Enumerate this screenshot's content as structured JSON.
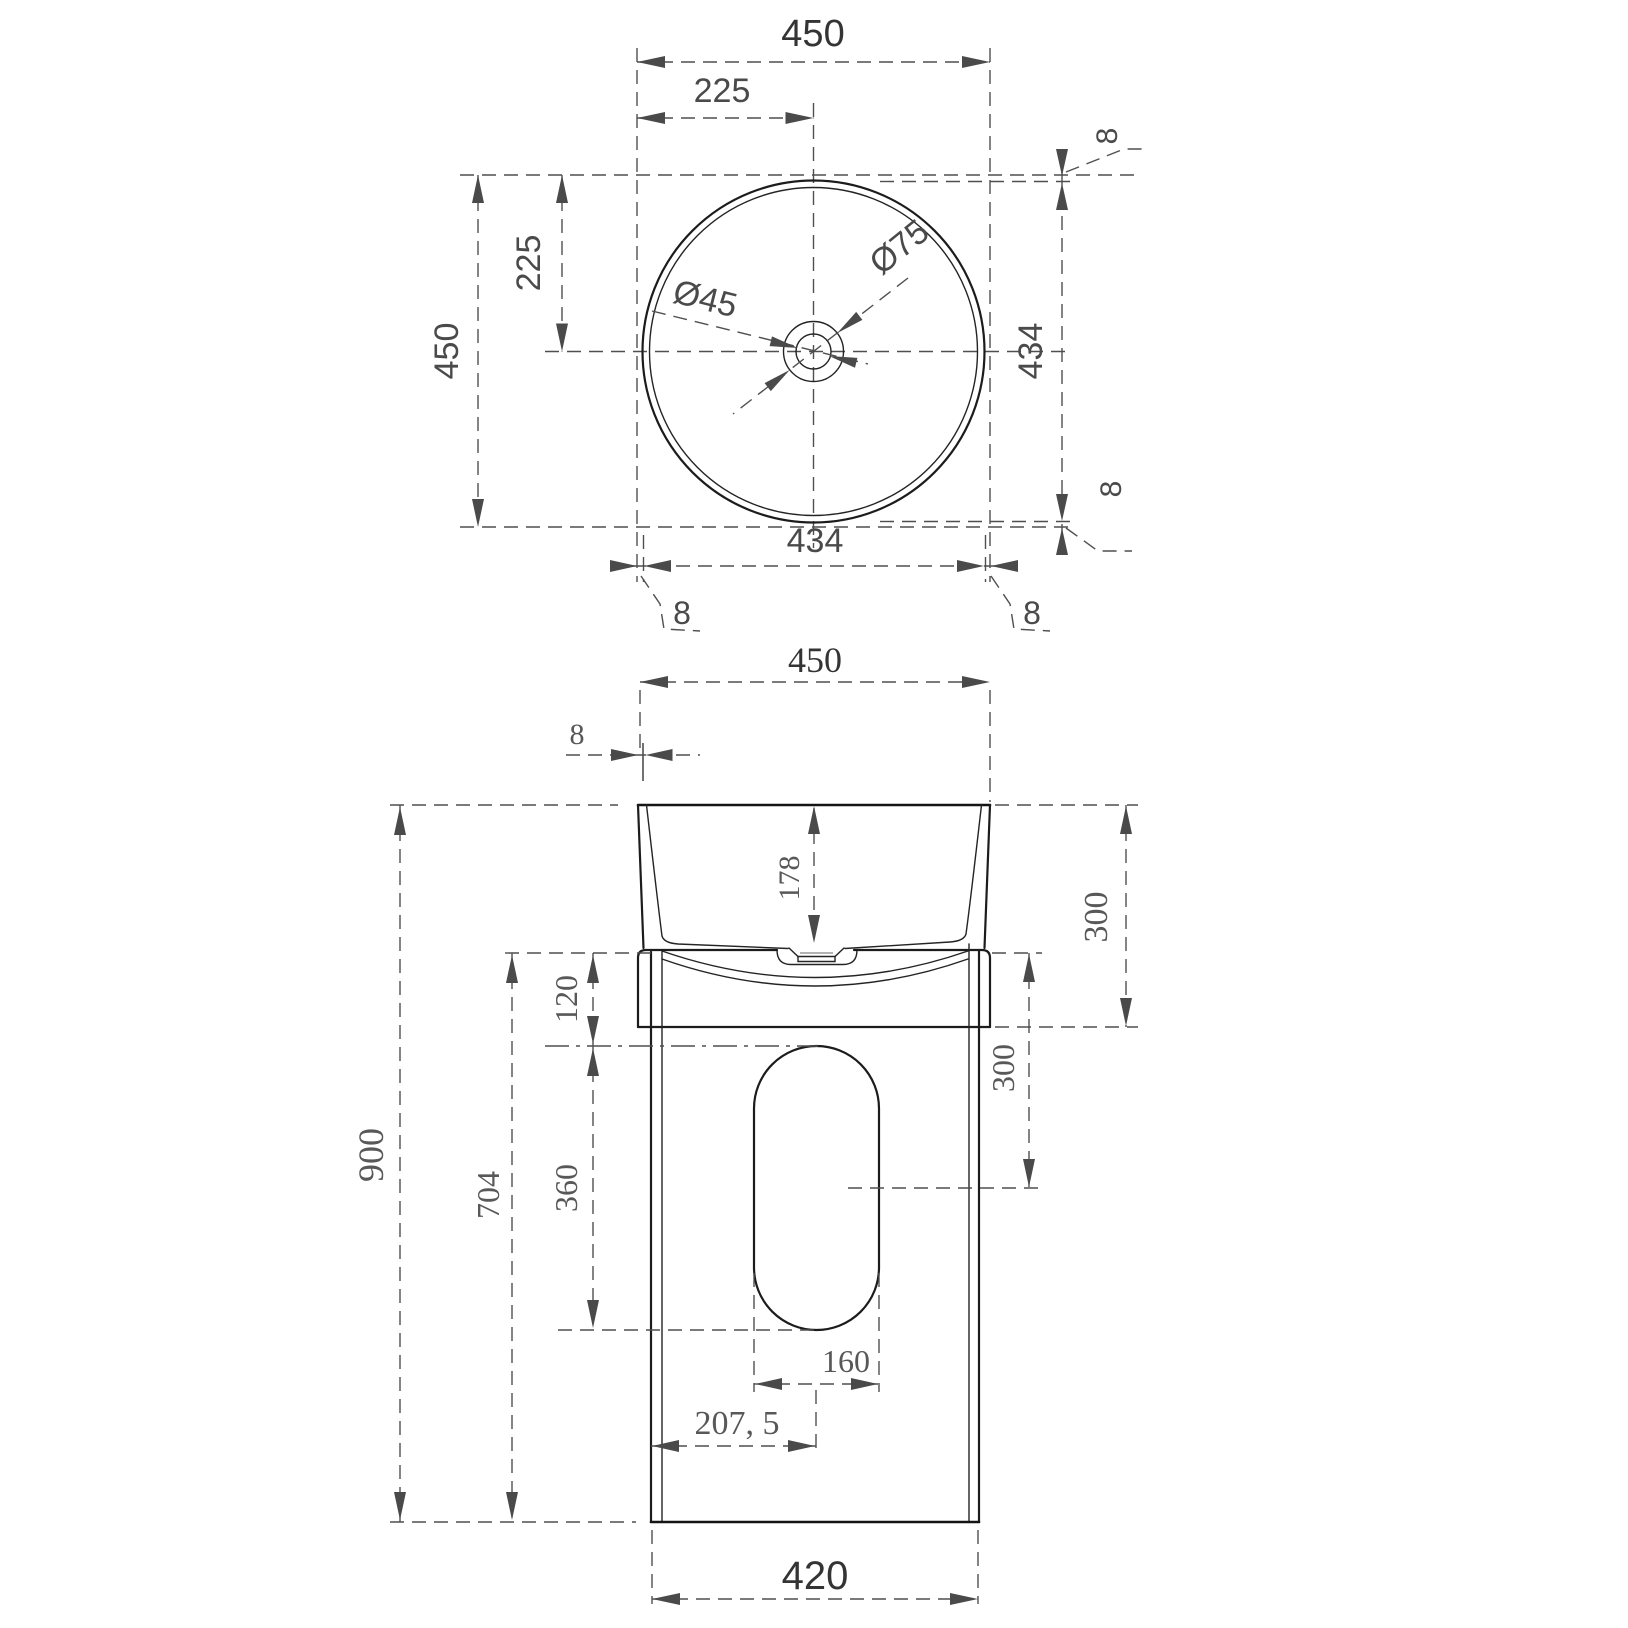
{
  "drawing": {
    "type": "pedestal-basin-dimension-drawing",
    "top_view": {
      "dims": {
        "overall_width": "450",
        "half_width": "225",
        "overall_depth": "450",
        "half_depth": "225",
        "inner_width": "434",
        "inner_depth": "434",
        "edge_offset_top": "8",
        "edge_offset_bottom": "8",
        "edge_offset_left": "8",
        "edge_offset_right": "8",
        "drain_hole_diameter": "Ø45",
        "drain_recess_diameter": "Ø75"
      }
    },
    "front_view": {
      "dims": {
        "top_width": "450",
        "wall_thickness": "8",
        "basin_inner_depth": "178",
        "basin_height": "300",
        "skirt_height": "120",
        "cutout_top_offset": "300",
        "cutout_height": "360",
        "cutout_width": "160",
        "pedestal_height": "704",
        "overall_height": "900",
        "cutout_center_offset": "207, 5",
        "base_width": "420"
      }
    },
    "colors": {
      "object_line": "#1c1c1c",
      "dimension_line": "#4f4f4f",
      "dimension_text": "#4a4a4a"
    }
  }
}
